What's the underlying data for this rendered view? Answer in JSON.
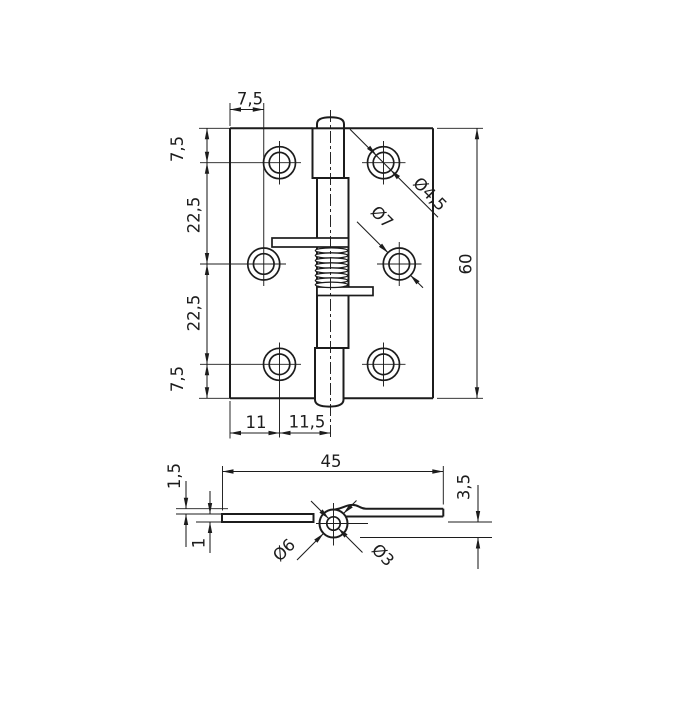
{
  "page": {
    "background_color": "#ffffff",
    "line_color": "#1c1c1c",
    "description": "Technical drawing of a 60 x 45 spring hinge, front view and side section view"
  },
  "front_view": {
    "dimensions": {
      "middle_hole_offset_top": "7,5",
      "vertical_chain": [
        "7,5",
        "22,5",
        "22,5",
        "7,5"
      ],
      "hole_offset_bottom": "11",
      "pin_offset_bottom": "11,5",
      "overall_height": "60"
    },
    "leaders": {
      "screw_hole_diameter": "Ø4,5",
      "countersink_diameter": "Ø7"
    }
  },
  "side_view": {
    "dimensions": {
      "overall_width": "45",
      "leaf_offset": "1,5",
      "leaf_thickness": "1",
      "knuckle_protrusion": "3,5"
    },
    "leaders": {
      "knuckle_diameter": "Ø6",
      "pin_diameter": "Ø3"
    }
  }
}
